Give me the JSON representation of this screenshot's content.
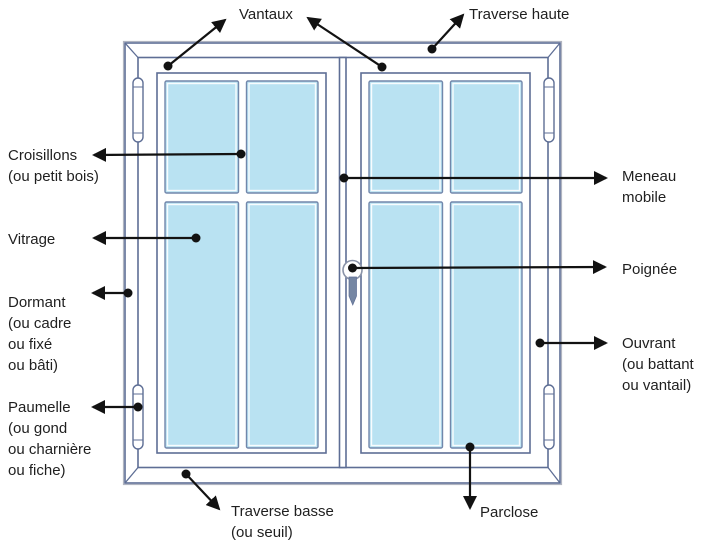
{
  "diagram_title": "Parties d'une fenêtre",
  "labels": {
    "vantaux": "Vantaux",
    "traverse_haute": "Traverse haute",
    "croisillons": [
      "Croisillons",
      "(ou petit bois)"
    ],
    "vitrage": "Vitrage",
    "dormant": [
      "Dormant",
      "(ou cadre",
      "ou fixé",
      "ou bâti)"
    ],
    "paumelle": [
      "Paumelle",
      "(ou gond",
      "ou charnière",
      "ou fiche)"
    ],
    "traverse_basse": [
      "Traverse basse",
      "(ou seuil)"
    ],
    "parclose": "Parclose",
    "meneau": [
      "Meneau",
      "mobile"
    ],
    "poignee": "Poignée",
    "ouvrant": [
      "Ouvrant",
      "(ou battant",
      "ou vantail)"
    ]
  },
  "colors": {
    "frame_line": "#5e6e95",
    "frame_light": "#b0b4c0",
    "glass": "#b9e2f2",
    "pane_border": "#7287ab",
    "handle": "#7586a3",
    "leader": "#121212",
    "text": "#1f1f1f",
    "background": "#ffffff"
  }
}
